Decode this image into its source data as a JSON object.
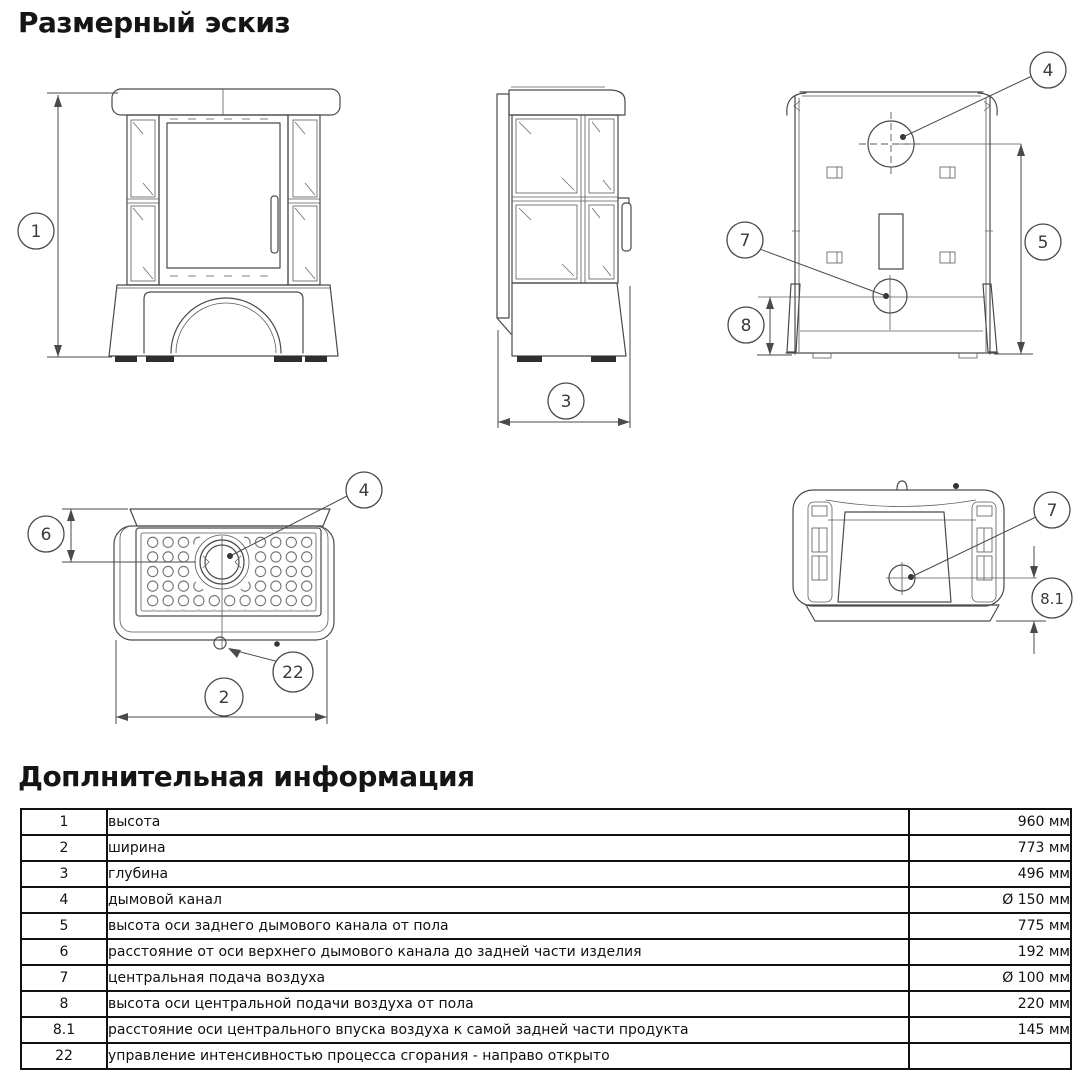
{
  "page": {
    "sketch_title": "Размерный эскиз",
    "info_title": "Доплнительная информация"
  },
  "callouts": {
    "c1": "1",
    "c2": "2",
    "c3": "3",
    "c4": "4",
    "c5": "5",
    "c6": "6",
    "c7": "7",
    "c8": "8",
    "c8_1": "8.1",
    "c22": "22"
  },
  "table": {
    "rows": [
      {
        "num": "1",
        "desc": "высота",
        "value": "960 мм"
      },
      {
        "num": "2",
        "desc": "ширина",
        "value": "773 мм"
      },
      {
        "num": "3",
        "desc": "глубина",
        "value": "496 мм"
      },
      {
        "num": "4",
        "desc": "дымовой канал",
        "value": "Ø 150 мм"
      },
      {
        "num": "5",
        "desc": "высота оси заднего дымового канала от пола",
        "value": "775 мм"
      },
      {
        "num": "6",
        "desc": "расстояние от оси верхнего дымового канала до задней части изделия",
        "value": "192 мм"
      },
      {
        "num": "7",
        "desc": "центральная подача воздуха",
        "value": "Ø 100 мм"
      },
      {
        "num": "8",
        "desc": "высота оси центральной подачи воздуха от пола",
        "value": "220 мм"
      },
      {
        "num": "8.1",
        "desc": "расстояние оси центрального впуска воздуха к самой задней части продукта",
        "value": "145 мм"
      },
      {
        "num": "22",
        "desc": "управление интенсивностью процесса сгорания - направо открыто",
        "value": ""
      }
    ]
  }
}
